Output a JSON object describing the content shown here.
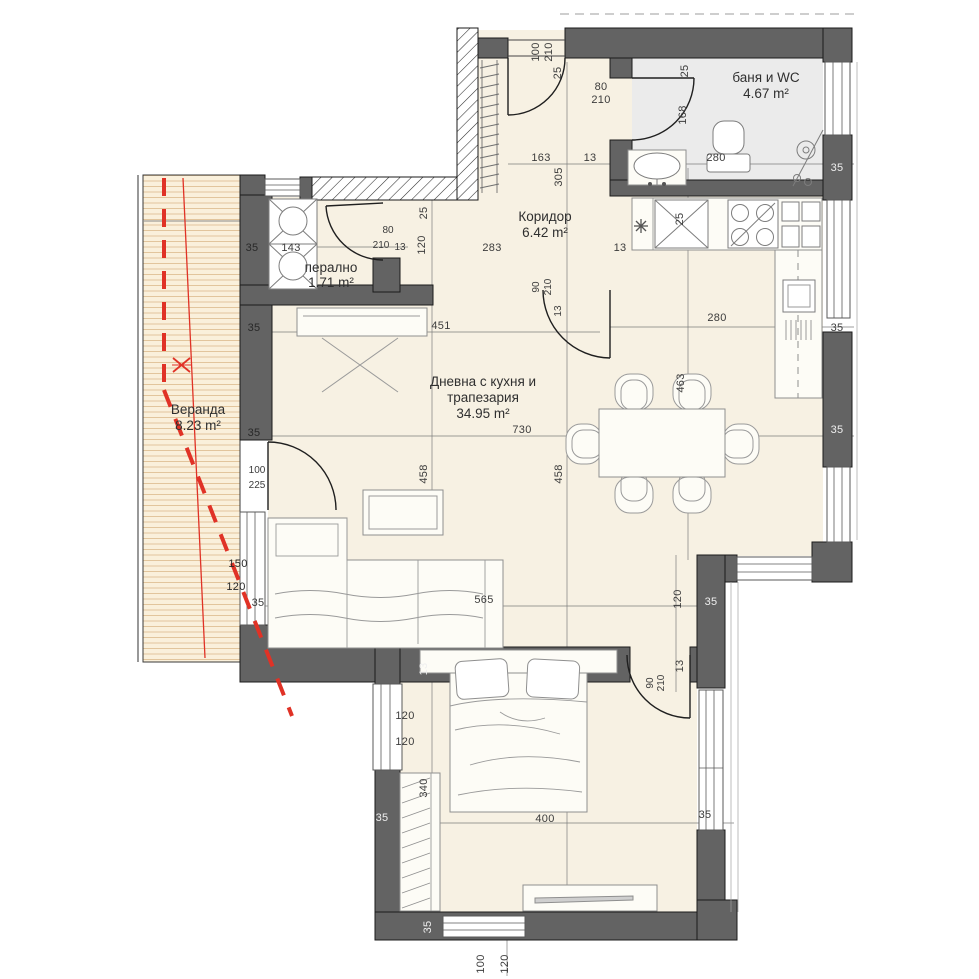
{
  "plan_title": "apartment-floor-plan",
  "rooms": {
    "bath": {
      "name": "баня и WC",
      "area": "4.67 m²"
    },
    "corridor": {
      "name": "Коридор",
      "area": "6.42 m²"
    },
    "laundry": {
      "name": "перално",
      "area": "1.71 m²"
    },
    "living": {
      "name1": "Дневна с кухня и",
      "name2": "трапезария",
      "area": "34.95 m²"
    },
    "veranda": {
      "name": "Веранда",
      "area": "8.23 m²"
    }
  },
  "dims": [
    "100",
    "210",
    "25",
    "25",
    "80",
    "210",
    "168",
    "163",
    "305",
    "13",
    "280",
    "35",
    "35",
    "143",
    "80",
    "210",
    "13",
    "25",
    "120",
    "283",
    "90",
    "210",
    "13",
    "451",
    "13",
    "25",
    "280",
    "35",
    "463",
    "730",
    "458",
    "458",
    "565",
    "35",
    "35",
    "35",
    "100",
    "225",
    "150",
    "120",
    "35",
    "13",
    "120",
    "120",
    "340",
    "400",
    "35",
    "35",
    "100",
    "120",
    "120",
    "35",
    "13",
    "90",
    "210",
    "35"
  ],
  "colors": {
    "wall": "#636363",
    "floor": "#f7f1e3",
    "bath_floor": "#ebebeb",
    "veranda_floor": "#faf0db",
    "veranda_lines": "#e2c59c",
    "annotation_red": "#e03226",
    "line": "#1b1b1b"
  }
}
